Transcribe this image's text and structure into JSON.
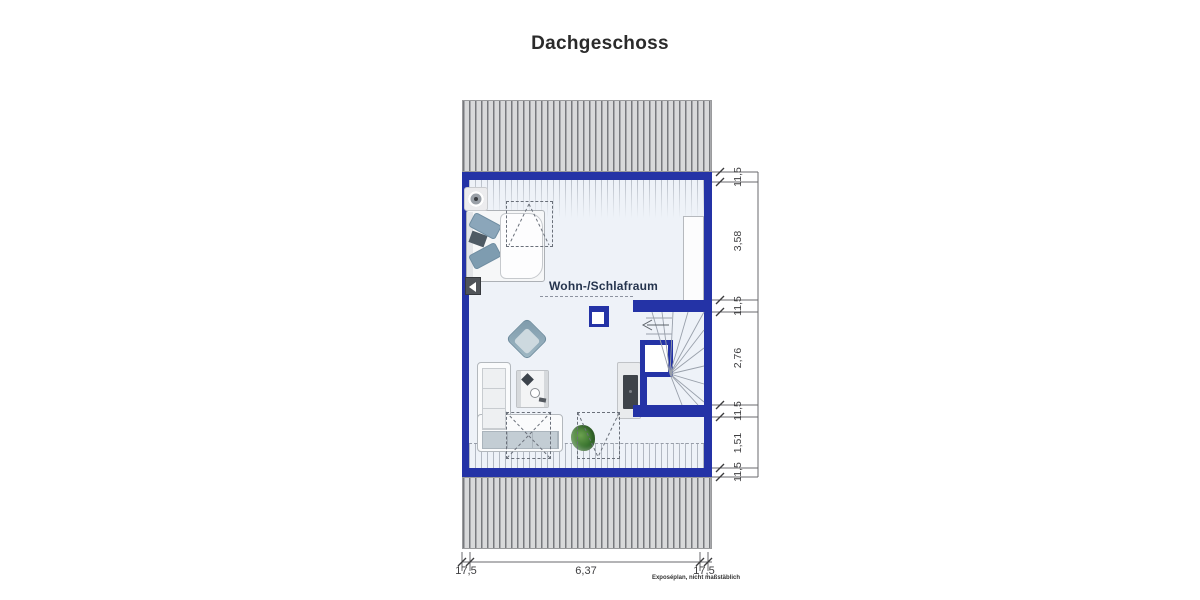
{
  "title": "Dachgeschoss",
  "plan": {
    "room_label": "Wohn-/Schlafraum",
    "disclaimer": "Exposéplan, nicht maßstäblich",
    "dim_right": [
      "11,5",
      "3,58",
      "11,5",
      "2,76",
      "11,5",
      "1,51",
      "11,5"
    ],
    "dim_bottom": [
      "17,5",
      "6,37",
      "17,5"
    ],
    "colors": {
      "wall_blue": "#2433a6",
      "roof_hatch_bg": "#d8d9da",
      "roof_hatch_line": "#77797d",
      "floor": "#eef2f8",
      "label_text": "#25344e"
    },
    "furniture": [
      "double-bed",
      "corner-sofa",
      "coffee-table",
      "armchair",
      "tv-sideboard",
      "plant",
      "winder-staircase",
      "wardrobe",
      "chimney",
      "ceiling-lamp",
      "wall-lamp"
    ]
  }
}
